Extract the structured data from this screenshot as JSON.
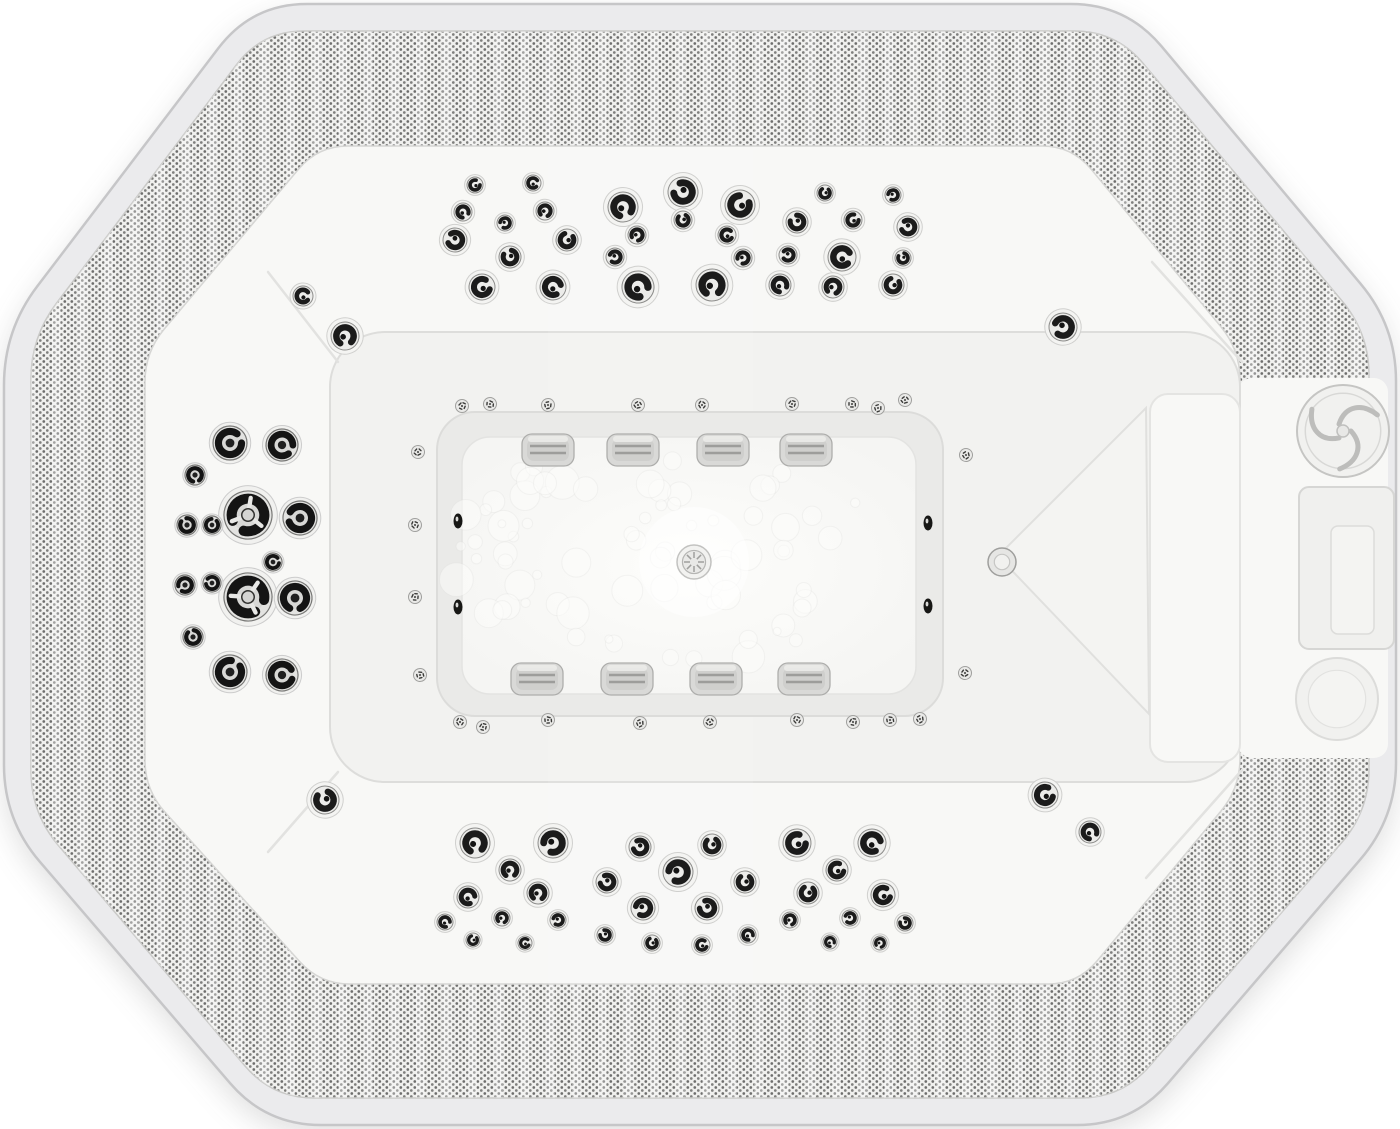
{
  "image": {
    "subject": "octagonal hot tub spa seen from directly above",
    "style": "grayscale-white product photograph",
    "canvas": {
      "width": 1400,
      "height": 1129
    }
  },
  "palette": {
    "background": "#ffffff",
    "outer_border": "#ebebed",
    "border_line": "#c6c6c8",
    "texture_base": "#f0f0ee",
    "texture_dot": "#4e4e4c",
    "shell_white": "#f8f8f6",
    "pit_floor": "#f2f2f0",
    "footwell_wall": "#eaeae8",
    "footwell_floor": "#f5f5f3",
    "jet_dark": "#1b1b1b",
    "chrome_light": "#ebebe9",
    "chrome_edge": "#9a9a98",
    "pillow_fill": "#d9d9d7",
    "pillow_slat": "#9d9d9b",
    "crease": "#dddddb"
  },
  "geometry": {
    "outer_octagon": [
      [
        252,
        4
      ],
      [
        1126,
        4
      ],
      [
        1396,
        326
      ],
      [
        1396,
        818
      ],
      [
        1132,
        1125
      ],
      [
        266,
        1125
      ],
      [
        4,
        820
      ],
      [
        4,
        330
      ]
    ],
    "texture_outer": [
      [
        262,
        31
      ],
      [
        1116,
        31
      ],
      [
        1369,
        333
      ],
      [
        1369,
        811
      ],
      [
        1122,
        1098
      ],
      [
        272,
        1098
      ],
      [
        31,
        813
      ],
      [
        31,
        337
      ]
    ],
    "texture_inner": [
      [
        318,
        146
      ],
      [
        1072,
        146
      ],
      [
        1240,
        350
      ],
      [
        1240,
        788
      ],
      [
        1078,
        984
      ],
      [
        320,
        984
      ],
      [
        145,
        790
      ],
      [
        145,
        352
      ]
    ],
    "corner_radius_outer": 55,
    "corner_radius_band": 42,
    "corner_radius_shell": 30,
    "pit": {
      "x": 330,
      "y": 332,
      "w": 910,
      "h": 450,
      "r": 55
    },
    "smooth_zone": {
      "x": 1238,
      "y": 378,
      "w": 150,
      "h": 380
    },
    "footwell_outer": {
      "x": 437,
      "y": 412,
      "w": 506,
      "h": 304,
      "r": 38
    },
    "footwell_floor": {
      "x": 462,
      "y": 437,
      "w": 454,
      "h": 257,
      "r": 28
    },
    "sheen_band": {
      "x": 548,
      "y": 150,
      "w": 205,
      "h": 845
    },
    "creases": [
      [
        338,
        362,
        268,
        272
      ],
      [
        1242,
        362,
        1152,
        262
      ],
      [
        338,
        772,
        268,
        852
      ],
      [
        1242,
        770,
        1146,
        878
      ]
    ]
  },
  "jets": {
    "top_wall": [
      [
        475,
        185,
        8
      ],
      [
        533,
        183,
        8
      ],
      [
        463,
        212,
        9
      ],
      [
        545,
        211,
        9
      ],
      [
        505,
        223,
        8
      ],
      [
        455,
        240,
        12
      ],
      [
        510,
        257,
        11
      ],
      [
        567,
        240,
        11
      ],
      [
        482,
        287,
        13
      ],
      [
        553,
        287,
        13
      ],
      [
        623,
        207,
        15
      ],
      [
        637,
        235,
        9
      ],
      [
        615,
        257,
        9
      ],
      [
        683,
        192,
        15
      ],
      [
        683,
        220,
        9
      ],
      [
        740,
        205,
        15
      ],
      [
        727,
        235,
        9
      ],
      [
        638,
        287,
        16
      ],
      [
        712,
        285,
        16
      ],
      [
        743,
        258,
        9
      ],
      [
        788,
        255,
        9
      ],
      [
        797,
        222,
        11
      ],
      [
        825,
        193,
        8
      ],
      [
        853,
        220,
        9
      ],
      [
        842,
        257,
        14
      ],
      [
        780,
        285,
        11
      ],
      [
        833,
        287,
        11
      ],
      [
        893,
        195,
        8
      ],
      [
        908,
        227,
        11
      ],
      [
        903,
        258,
        8
      ],
      [
        893,
        285,
        11
      ]
    ],
    "bottom_wall": [
      [
        475,
        843,
        15
      ],
      [
        553,
        843,
        15
      ],
      [
        640,
        847,
        11
      ],
      [
        712,
        845,
        11
      ],
      [
        797,
        843,
        14
      ],
      [
        872,
        843,
        14
      ],
      [
        510,
        870,
        11
      ],
      [
        678,
        872,
        15
      ],
      [
        607,
        882,
        11
      ],
      [
        745,
        882,
        11
      ],
      [
        837,
        870,
        11
      ],
      [
        468,
        897,
        11
      ],
      [
        538,
        893,
        11
      ],
      [
        643,
        908,
        12
      ],
      [
        707,
        908,
        12
      ],
      [
        808,
        893,
        11
      ],
      [
        883,
        895,
        12
      ],
      [
        445,
        922,
        8
      ],
      [
        502,
        918,
        8
      ],
      [
        558,
        920,
        8
      ],
      [
        605,
        935,
        8
      ],
      [
        652,
        943,
        8
      ],
      [
        702,
        945,
        8
      ],
      [
        748,
        935,
        8
      ],
      [
        790,
        920,
        8
      ],
      [
        850,
        918,
        8
      ],
      [
        905,
        923,
        8
      ],
      [
        473,
        940,
        7
      ],
      [
        525,
        943,
        7
      ],
      [
        830,
        942,
        7
      ],
      [
        880,
        943,
        7
      ]
    ],
    "left_wall": [
      [
        230,
        443,
        17,
        "ring"
      ],
      [
        282,
        445,
        16,
        "ring"
      ],
      [
        195,
        475,
        10,
        "ring"
      ],
      [
        248,
        515,
        24,
        "tri"
      ],
      [
        300,
        518,
        17,
        "ring"
      ],
      [
        187,
        525,
        10,
        "ring"
      ],
      [
        212,
        525,
        9,
        "ring"
      ],
      [
        273,
        562,
        9,
        "ring"
      ],
      [
        248,
        597,
        24,
        "tri"
      ],
      [
        295,
        598,
        17,
        "ring"
      ],
      [
        185,
        585,
        10,
        "ring"
      ],
      [
        212,
        583,
        9,
        "ring"
      ],
      [
        193,
        637,
        10,
        "ring"
      ],
      [
        230,
        672,
        17,
        "ring"
      ],
      [
        282,
        675,
        16,
        "ring"
      ]
    ],
    "corner_jets": [
      [
        303,
        296,
        10
      ],
      [
        345,
        336,
        14
      ],
      [
        1063,
        327,
        14
      ],
      [
        325,
        800,
        14
      ],
      [
        1045,
        795,
        13
      ],
      [
        1090,
        832,
        11
      ]
    ],
    "air_buttons": [
      [
        462,
        406
      ],
      [
        490,
        404
      ],
      [
        548,
        405
      ],
      [
        638,
        405
      ],
      [
        702,
        405
      ],
      [
        792,
        404
      ],
      [
        852,
        404
      ],
      [
        878,
        408
      ],
      [
        905,
        400
      ],
      [
        460,
        722
      ],
      [
        483,
        727
      ],
      [
        548,
        720
      ],
      [
        640,
        723
      ],
      [
        710,
        722
      ],
      [
        797,
        720
      ],
      [
        853,
        722
      ],
      [
        890,
        720
      ],
      [
        920,
        719
      ],
      [
        418,
        452
      ],
      [
        415,
        525
      ],
      [
        415,
        597
      ],
      [
        420,
        675
      ],
      [
        966,
        455
      ],
      [
        965,
        673
      ]
    ],
    "suction_ovals": [
      [
        458,
        521
      ],
      [
        458,
        607
      ],
      [
        928,
        523
      ],
      [
        928,
        606
      ]
    ],
    "pillow_vents_top": [
      [
        548,
        450
      ],
      [
        633,
        450
      ],
      [
        723,
        450
      ],
      [
        806,
        450
      ]
    ],
    "pillow_vents_bottom": [
      [
        537,
        679
      ],
      [
        627,
        679
      ],
      [
        716,
        679
      ],
      [
        804,
        679
      ]
    ]
  },
  "features": {
    "drain": {
      "x": 694,
      "y": 562,
      "r": 17
    },
    "lounge_back": [
      [
        1146,
        408
      ],
      [
        998,
        556
      ],
      [
        1149,
        714
      ]
    ],
    "lounge_seat": {
      "x": 1150,
      "y": 394,
      "w": 90,
      "h": 368
    },
    "headrest_knob": {
      "x": 1002,
      "y": 562,
      "r": 14
    },
    "speaker_dial": {
      "x": 1343,
      "y": 431,
      "r": 46
    },
    "control_recess": {
      "x": 1299,
      "y": 487,
      "w": 95,
      "h": 162
    },
    "control_recess_inner": {
      "x": 1331,
      "y": 526,
      "w": 43,
      "h": 108
    },
    "cup_recess": {
      "x": 1337,
      "y": 699,
      "r": 41
    },
    "bubbles": {
      "seed": 11,
      "count": 74,
      "cx": 665,
      "cy": 560,
      "rx": 220,
      "ry": 118
    }
  }
}
